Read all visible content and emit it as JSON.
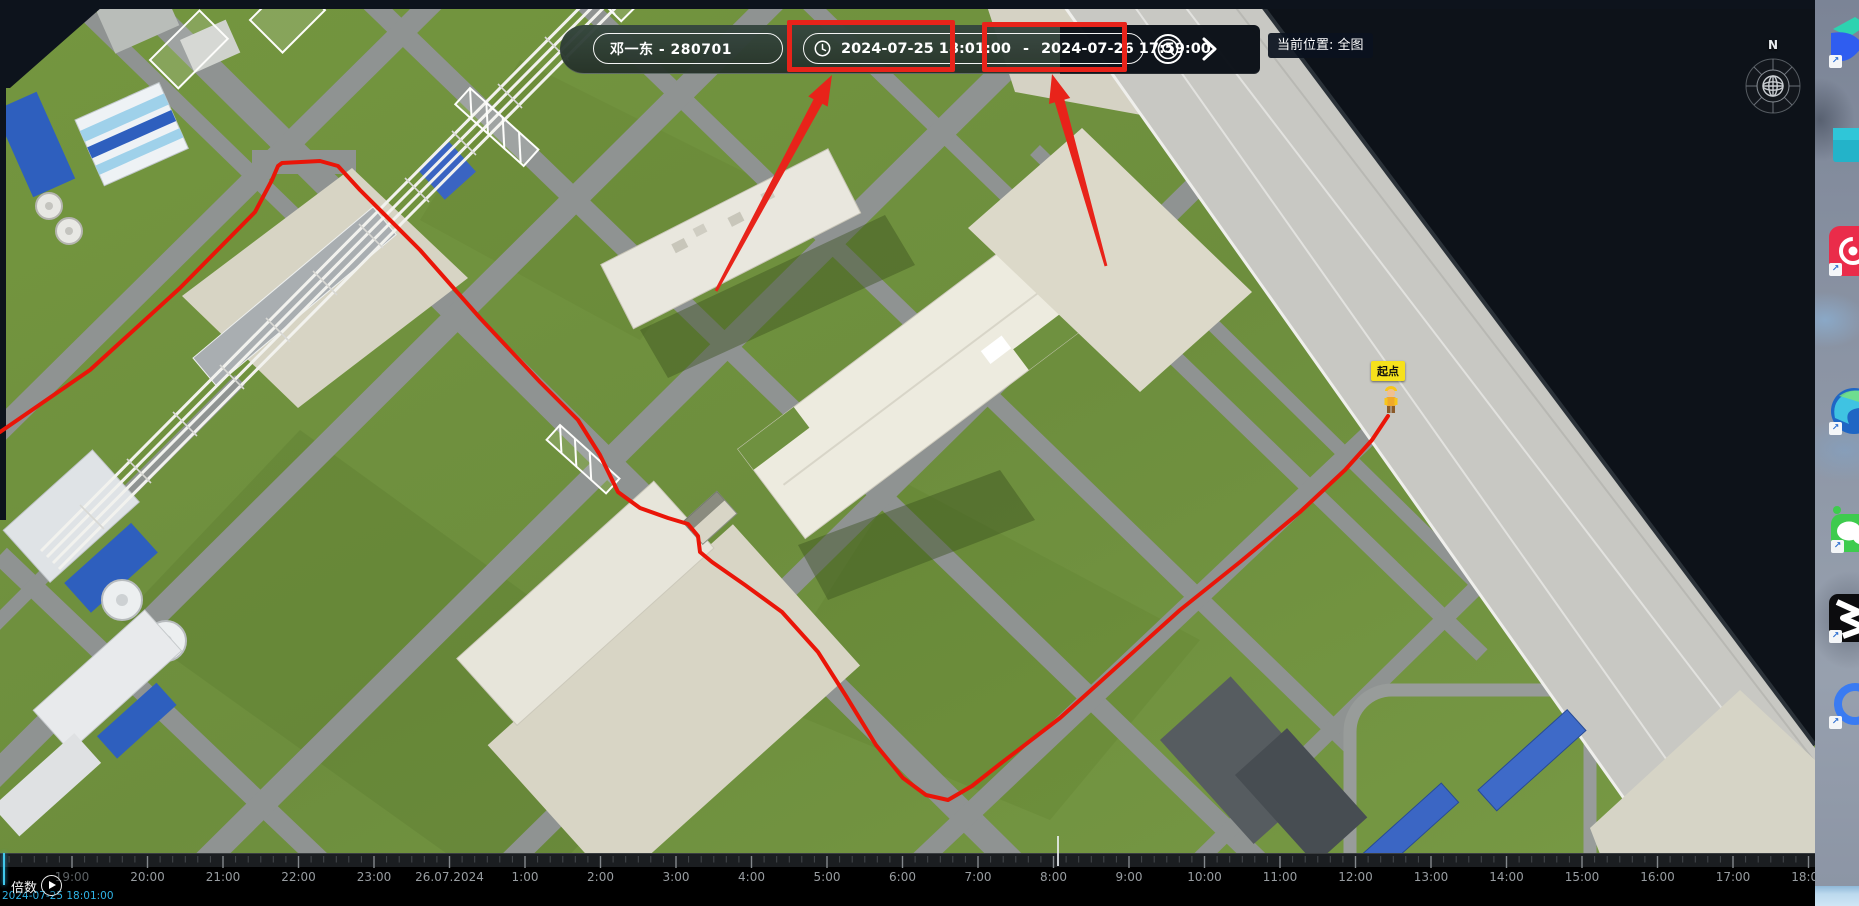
{
  "toolbar": {
    "person": "邓一东 - 280701",
    "time_start": "2024-07-25 18:01:00",
    "time_separator": "-",
    "time_end": "2024-07-26 17:59:00",
    "location_label": "当前位置: 全图"
  },
  "map": {
    "start_marker_label": "起点",
    "compass_label": "N"
  },
  "timeline": {
    "multiplier_label": "倍数",
    "playhead_time": "2024-07-25 18:01:00",
    "labels": [
      "19:00",
      "20:00",
      "21:00",
      "22:00",
      "23:00",
      "26.07.2024",
      "1:00",
      "2:00",
      "3:00",
      "4:00",
      "5:00",
      "6:00",
      "7:00",
      "8:00",
      "9:00",
      "10:00",
      "11:00",
      "12:00",
      "13:00",
      "14:00",
      "15:00",
      "16:00",
      "17:00",
      "18:00"
    ]
  },
  "desktop": {
    "icons": [
      {
        "id": "feishu",
        "label": "飞"
      },
      {
        "id": "this-pc",
        "label": "此电"
      },
      {
        "id": "netease-mail",
        "label": "网易"
      },
      {
        "id": "microsoft-edge",
        "label_line1": "Micr",
        "label_line2": "Ed"
      },
      {
        "id": "wechat",
        "label": "微"
      },
      {
        "id": "jianying",
        "label": "剪映"
      },
      {
        "id": "wecom",
        "label": "企业"
      }
    ],
    "shortcut_arrow": "↗"
  },
  "colors": {
    "annotation_red": "#e8231a",
    "track_red": "#ea1508",
    "marker_yellow": "#f6e11c",
    "playhead_cyan": "#2fb3e6",
    "water_dark": "#0d1219"
  }
}
